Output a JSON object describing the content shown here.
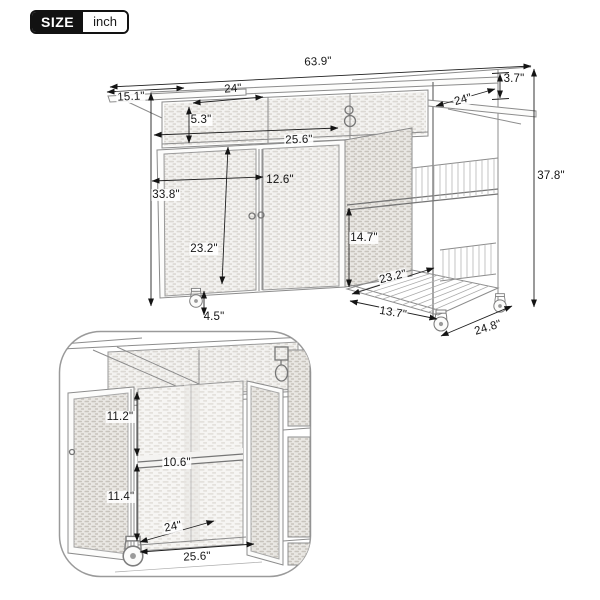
{
  "size_badge": {
    "label": "SIZE",
    "unit": "inch"
  },
  "main_view": {
    "total_width_with_leaves": "63.9\"",
    "side_leaf_depth": "15.1\"",
    "top_shelf_width": "24\"",
    "top_shelf_height": "5.3\"",
    "cabinet_width": "25.6\"",
    "cabinet_depth": "12.6\"",
    "counter_height": "33.8\"",
    "door_height": "23.2\"",
    "shelf_spacing_height": "14.7\"",
    "side_shelf_depth": "23.2\"",
    "caster_height": "4.5\"",
    "bottom_shelf_width": "13.7\"",
    "overall_depth": "24.8\"",
    "overall_height": "37.8\"",
    "countertop_thickness": "3.7\"",
    "folded_leaf_width": "24\""
  },
  "inset_view": {
    "upper_compartment_height": "11.2\"",
    "middle_shelf_depth": "10.6\"",
    "lower_compartment_height": "11.4\"",
    "interior_depth": "24\"",
    "interior_width": "25.6\""
  }
}
